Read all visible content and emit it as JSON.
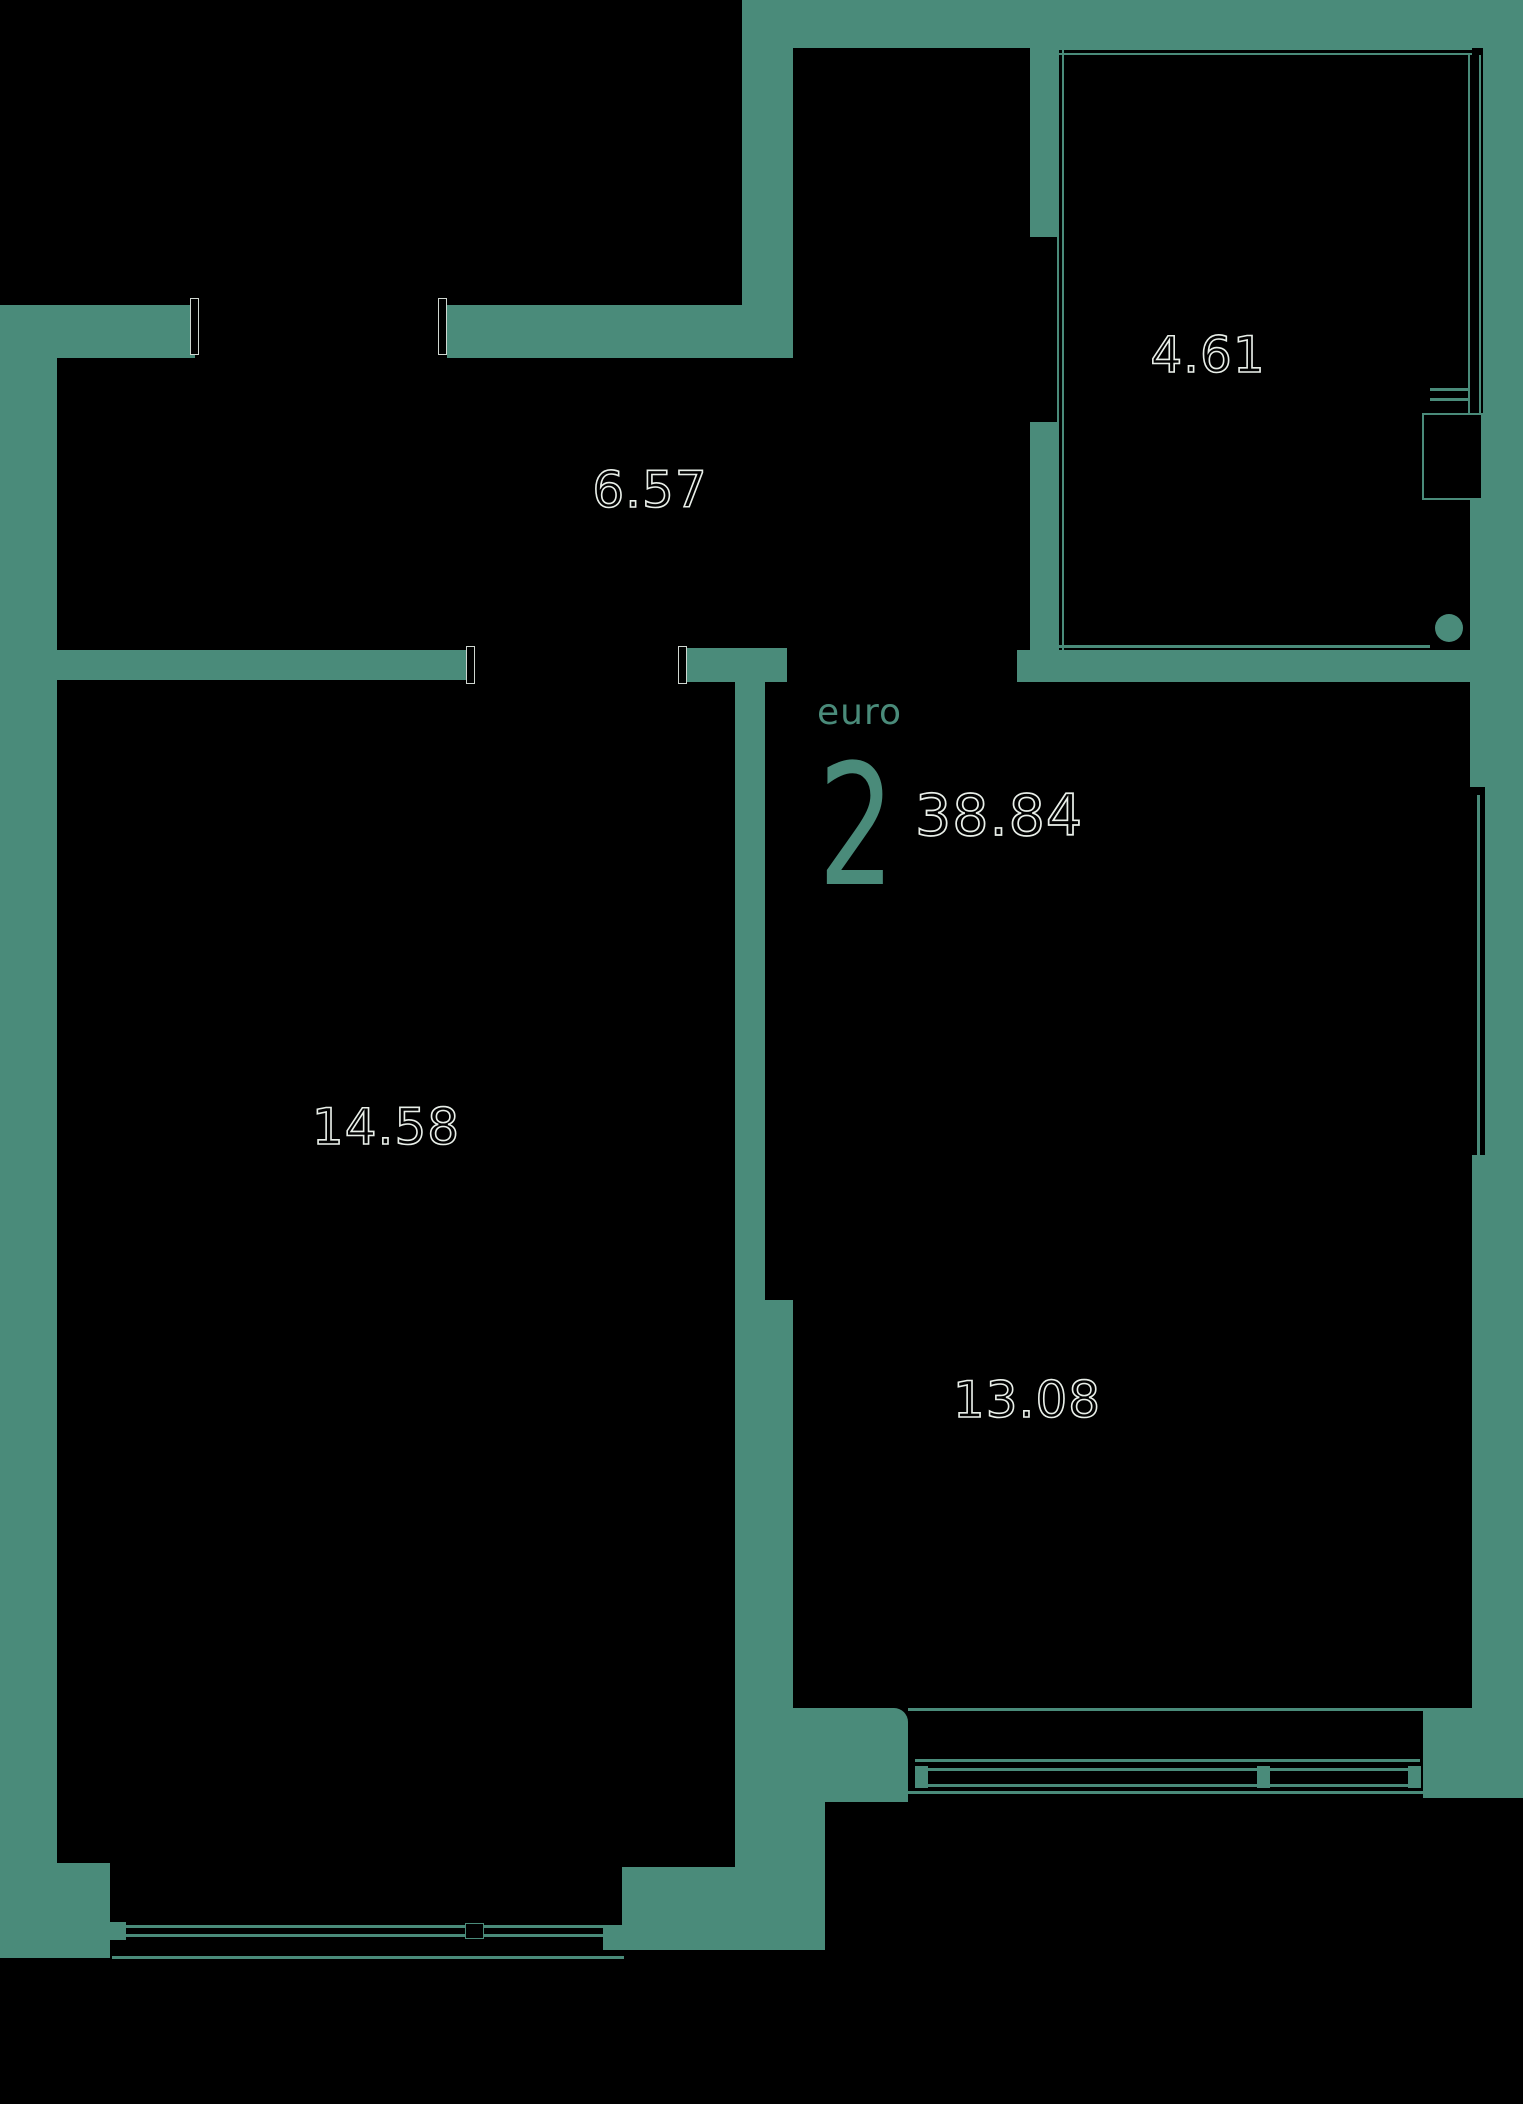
{
  "plan": {
    "title": {
      "type_label": "euro",
      "rooms_count": "2",
      "total_area": "38.84"
    },
    "rooms": [
      {
        "name": "hall",
        "area": "6.57"
      },
      {
        "name": "balcony",
        "area": "4.61"
      },
      {
        "name": "bedroom",
        "area": "14.58"
      },
      {
        "name": "living-kitchen",
        "area": "13.08"
      }
    ],
    "colors": {
      "wall": "#4a8b7a",
      "background": "#000000",
      "label_outline": "#e9efe9",
      "jamb_outline": "#cfd6d0"
    }
  }
}
